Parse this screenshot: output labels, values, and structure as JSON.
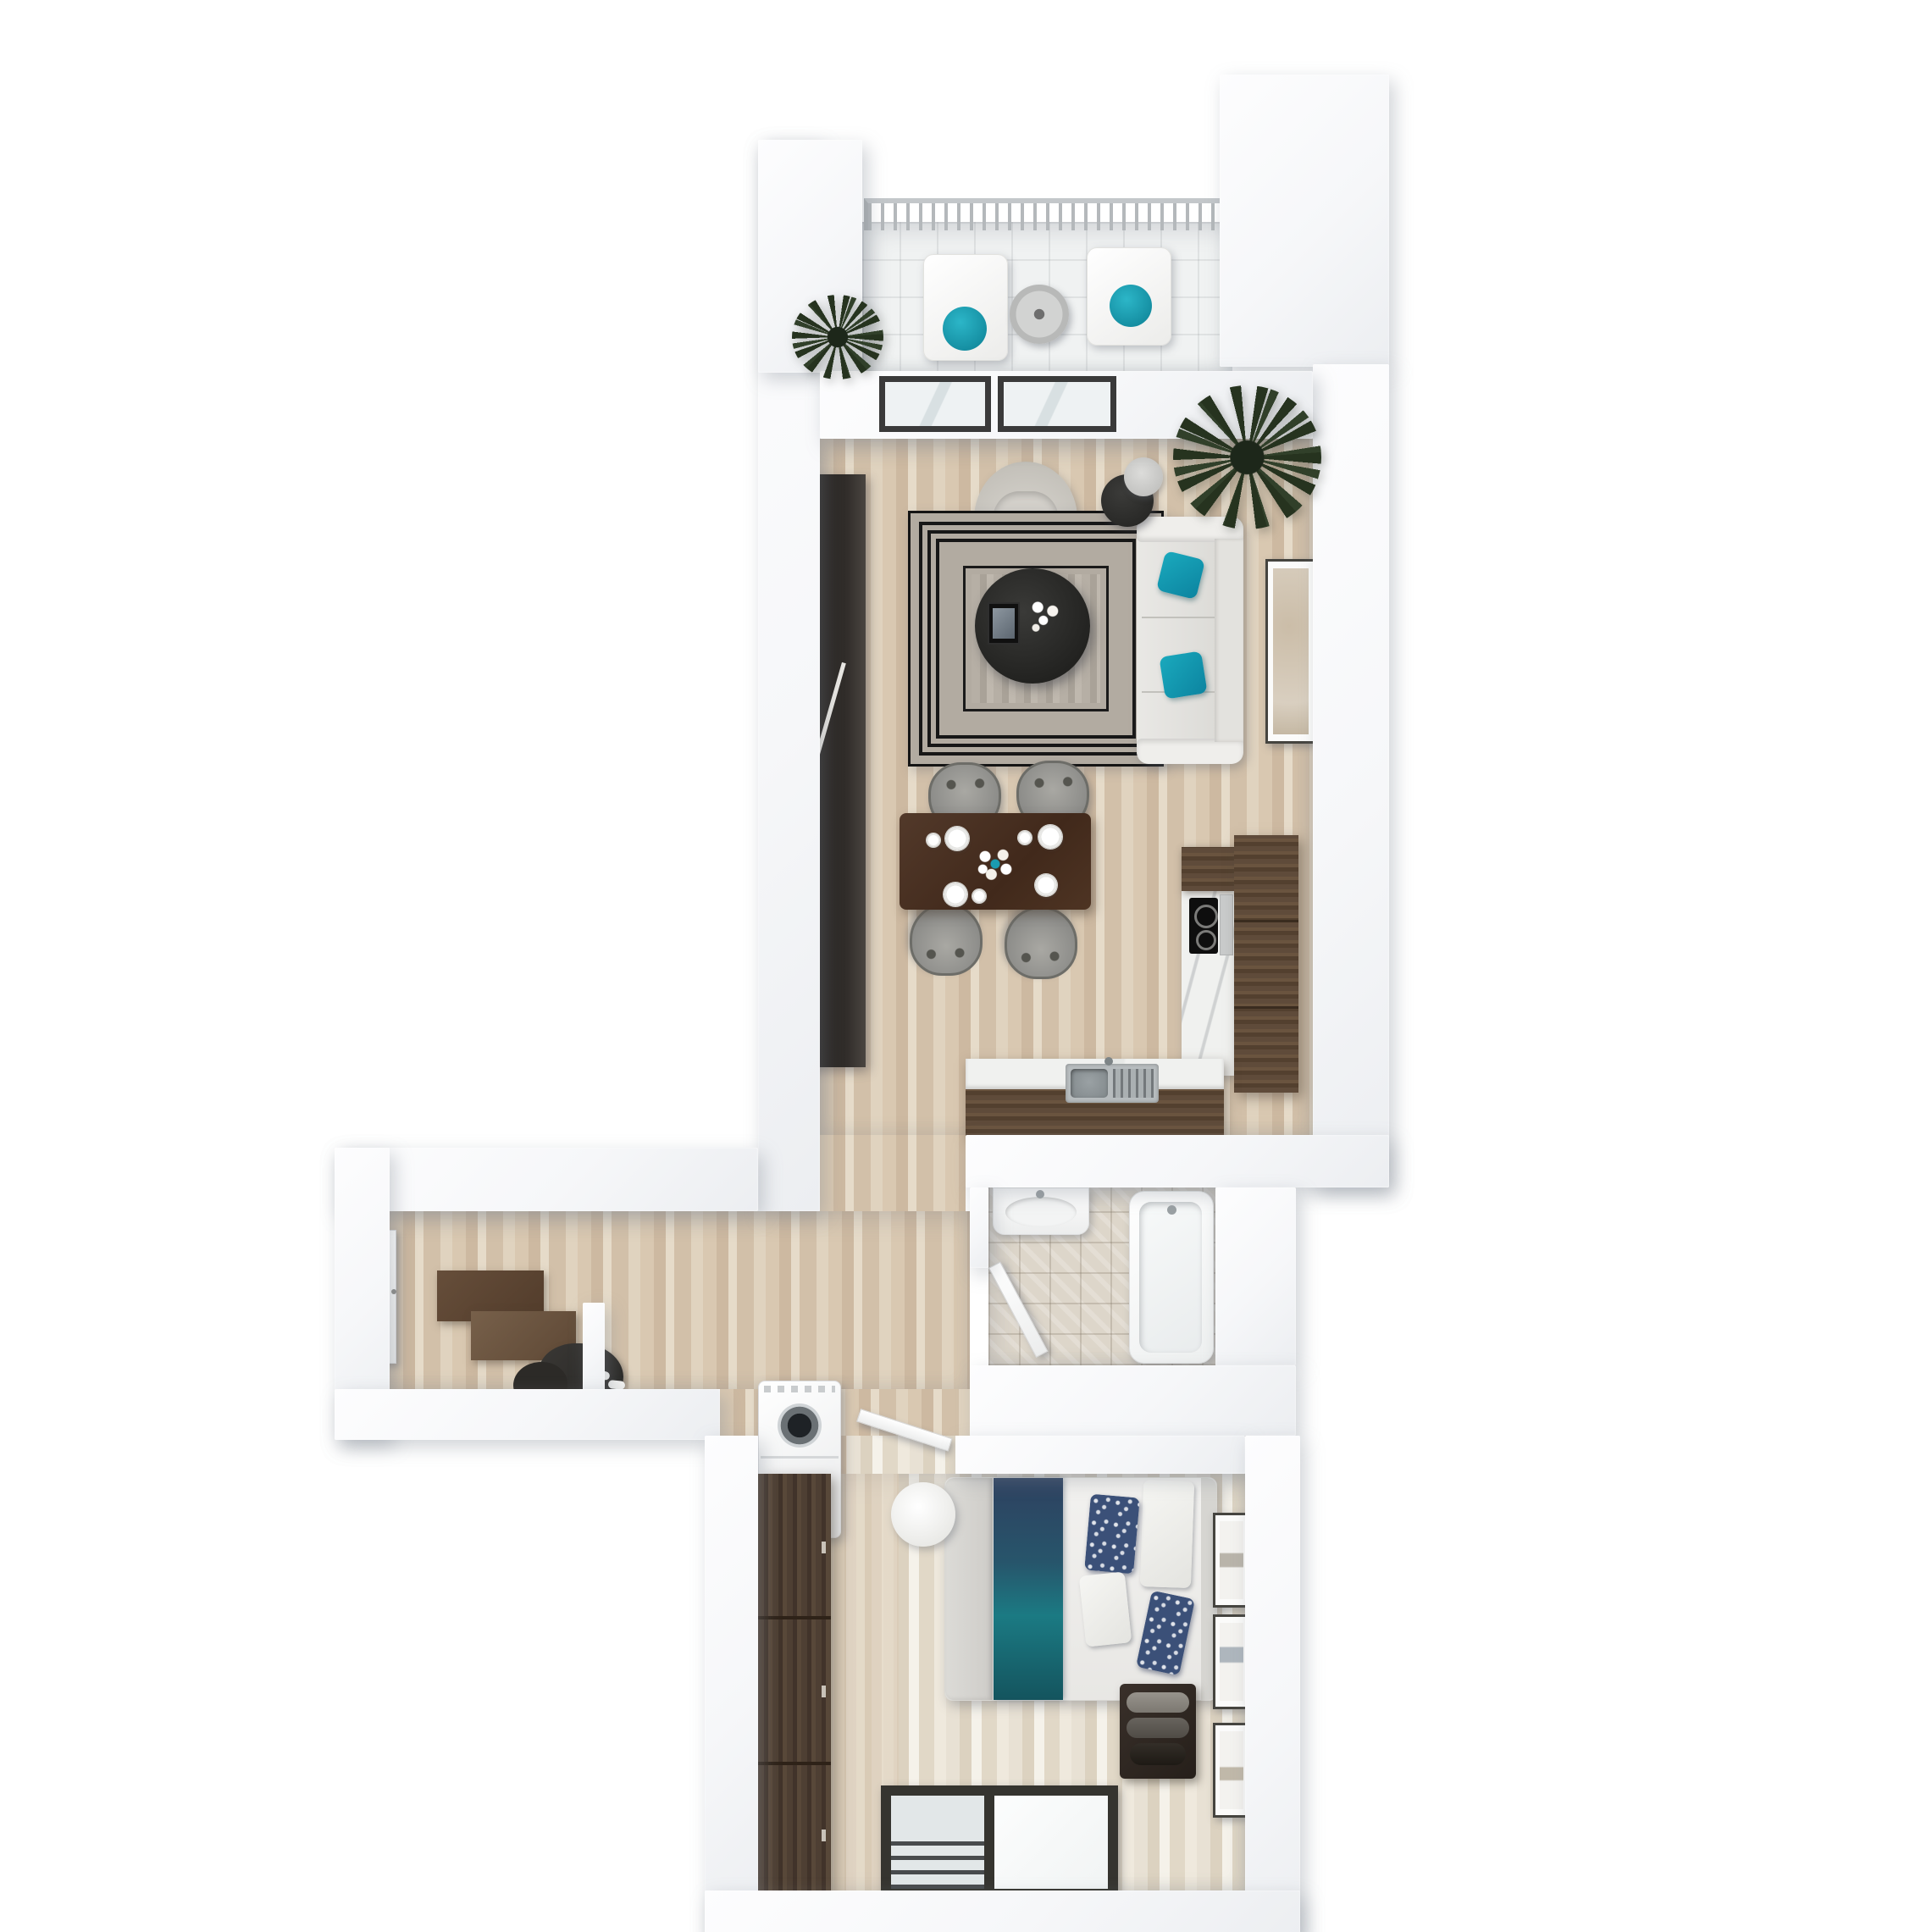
{
  "scene": {
    "type": "3d-floor-plan-render",
    "view": "top-down-dollhouse",
    "background_color": "#ffffff",
    "wall_color": "#f7f8fa",
    "accent_colors": {
      "teal": "#129bb0",
      "navy": "#3b5078",
      "wood_floor": "#d5c3ac",
      "whitewashed_floor": "#e9e3d8",
      "dark_wood_furniture": "#54412f",
      "near_black_furniture": "#262220",
      "marble_counter": "#f0f1ef",
      "steel_sink": "#aeb4b6",
      "grey_fabric": "#999996",
      "balcony_tile": "#f0f2f2",
      "bath_tile": "#ddd6ca"
    },
    "rooms": [
      {
        "id": "balcony",
        "items": [
          {
            "name": "balcony-railing",
            "color": "#b4b8bb"
          },
          {
            "name": "balcony-plant",
            "color": "#26331f"
          },
          {
            "name": "lounge-chair-1",
            "color": "#ffffff",
            "cushion": "#129bb0"
          },
          {
            "name": "lounge-chair-2",
            "color": "#ffffff",
            "cushion": "#129bb0"
          },
          {
            "name": "patio-table",
            "color": "#c9cac9"
          }
        ]
      },
      {
        "id": "living-room",
        "items": [
          {
            "name": "sliding-glass-door",
            "frame": "#3a3a3a",
            "glass": "#e9eef0"
          },
          {
            "name": "media-wall-unit",
            "color": "#262220"
          },
          {
            "name": "armchair",
            "color": "#cfccc6"
          },
          {
            "name": "area-rug",
            "field": "#b2aba1",
            "border_lines": "#171717"
          },
          {
            "name": "round-coffee-table",
            "color": "#2b2b29"
          },
          {
            "name": "decor-tray",
            "color": "#111111"
          },
          {
            "name": "flower-bouquet",
            "color": "#ffffff"
          },
          {
            "name": "sofa",
            "color": "#e7e6e3"
          },
          {
            "name": "sofa-pillow-1",
            "color": "#129bb0"
          },
          {
            "name": "sofa-pillow-2",
            "color": "#129bb0"
          },
          {
            "name": "side-table",
            "color": "#2c2c2a"
          },
          {
            "name": "table-lamp",
            "color": "#c9c9c7"
          },
          {
            "name": "leaning-art-frame",
            "mat": "#d8cfc2"
          },
          {
            "name": "corner-palm-plant",
            "color": "#26331f"
          }
        ]
      },
      {
        "id": "dining-area",
        "items": [
          {
            "name": "dining-table",
            "color": "#4a3322"
          },
          {
            "name": "dining-chairs",
            "count": 4,
            "color": "#8b8b88"
          },
          {
            "name": "place-settings",
            "count": 4,
            "plate_color": "#ffffff"
          },
          {
            "name": "flower-centerpiece",
            "colors": [
              "#ffffff",
              "#129bb0"
            ]
          }
        ]
      },
      {
        "id": "kitchen",
        "items": [
          {
            "name": "marble-counter-run",
            "color": "#f0f1ef"
          },
          {
            "name": "upper-dark-cabinet",
            "color": "#54412f"
          },
          {
            "name": "cooktop",
            "color": "#101010"
          },
          {
            "name": "cutting-board",
            "color": "#c9cbcb"
          },
          {
            "name": "tall-cabinet-column",
            "color": "#5f4b3a"
          },
          {
            "name": "sink-counter",
            "top": "#f0f1ef",
            "front": "#54412f"
          },
          {
            "name": "kitchen-sink",
            "color": "#aeb4b6"
          }
        ]
      },
      {
        "id": "hallway",
        "items": [
          {
            "name": "entry-door",
            "color": "#ffffff"
          },
          {
            "name": "shoe-console-lower",
            "color": "#5c4534"
          },
          {
            "name": "shoe-console-upper",
            "color": "#6e5440"
          },
          {
            "name": "coat-pile",
            "color": "#33312e"
          },
          {
            "name": "slippers",
            "color": "#ffffff"
          },
          {
            "name": "partition-stub-wall",
            "color": "#f7f8fa"
          },
          {
            "name": "washing-machine",
            "color": "#ffffff",
            "lid": "#1e2226"
          }
        ]
      },
      {
        "id": "bathroom",
        "items": [
          {
            "name": "washbasin",
            "color": "#ffffff"
          },
          {
            "name": "bathtub",
            "color": "#ffffff"
          },
          {
            "name": "bathroom-door",
            "color": "#ffffff"
          },
          {
            "name": "tile-floor",
            "color": "#ddd6ca"
          }
        ]
      },
      {
        "id": "bedroom",
        "items": [
          {
            "name": "wardrobe",
            "color": "#493b2f",
            "doors": 3
          },
          {
            "name": "double-bed",
            "duvet": "#f0efed"
          },
          {
            "name": "bed-runner",
            "colors": [
              "#2e4160",
              "#1b7a83"
            ]
          },
          {
            "name": "navy-pillows",
            "count": 2,
            "color": "#3b5078"
          },
          {
            "name": "white-pillows",
            "count": 2,
            "color": "#f2f2ef"
          },
          {
            "name": "headboard",
            "color": "#d6d5d1"
          },
          {
            "name": "storage-bench",
            "color": "#2f2822"
          },
          {
            "name": "blanket-rolls",
            "count": 3
          },
          {
            "name": "wall-art-frames",
            "count": 3,
            "color": "#fbfbfa"
          },
          {
            "name": "bedside-round-table",
            "color": "#f6f6f4"
          },
          {
            "name": "bedroom-door",
            "color": "#ffffff"
          },
          {
            "name": "french-window",
            "frame": "#35342f"
          },
          {
            "name": "juliet-railing",
            "color": "#3c3e40"
          }
        ]
      }
    ]
  }
}
